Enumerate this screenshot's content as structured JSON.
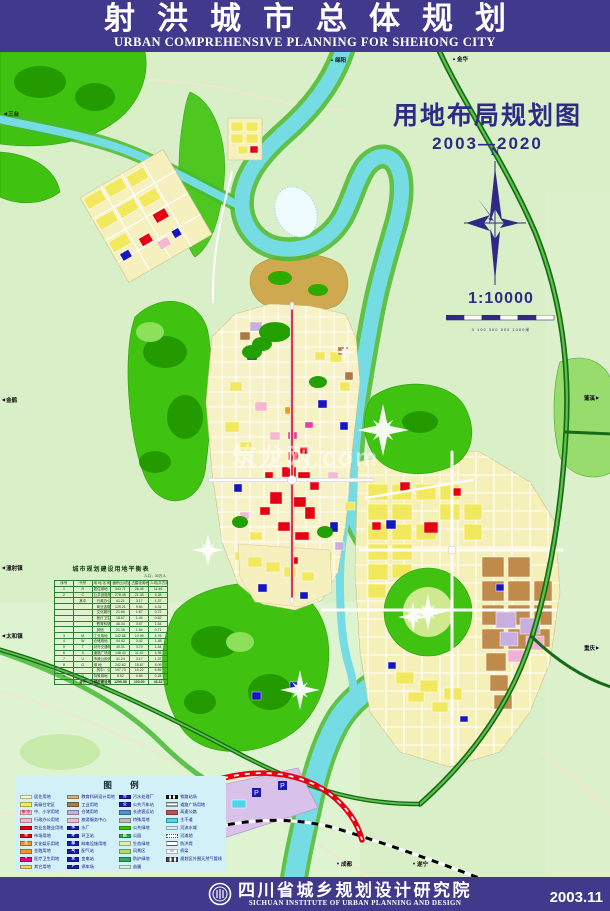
{
  "header": {
    "title_cn": "射洪城市总体规划",
    "title_en": "URBAN COMPREHENSIVE PLANNING FOR SHEHONG CITY"
  },
  "map": {
    "title": "用地布局规划图",
    "period": "2003—2020",
    "compass_label": "N",
    "scale_text": "1:10000",
    "scale_ticks": "0  100  300  500  1000米",
    "watermark": "筑龙网.com",
    "edge_labels": [
      {
        "text": "三台",
        "x": 4,
        "y": 58,
        "dir": "left"
      },
      {
        "text": "绵阳",
        "x": 330,
        "y": 4,
        "dir": "up"
      },
      {
        "text": "金华",
        "x": 452,
        "y": 3,
        "dir": "up"
      },
      {
        "text": "金鹤",
        "x": 2,
        "y": 344,
        "dir": "left"
      },
      {
        "text": "潼射镇",
        "x": 2,
        "y": 512,
        "dir": "left"
      },
      {
        "text": "太和镇",
        "x": 2,
        "y": 580,
        "dir": "left"
      },
      {
        "text": "蓬溪",
        "x": 584,
        "y": 342,
        "dir": "right"
      },
      {
        "text": "重庆",
        "x": 584,
        "y": 592,
        "dir": "right"
      },
      {
        "text": "成都",
        "x": 336,
        "y": 808,
        "dir": "down"
      },
      {
        "text": "遂宁",
        "x": 412,
        "y": 808,
        "dir": "down"
      }
    ]
  },
  "table": {
    "title": "城市规划建设用地平衡表",
    "note": "人口：30万人",
    "headers": [
      "序号",
      "代号",
      "用 地 名 称",
      "面积(公顷)",
      "占建设用地(%)",
      "人均(平方米/人)"
    ],
    "rows": [
      {
        "no": "1",
        "code": "R",
        "name": "居住用地",
        "area": "343.71",
        "pct": "26.45",
        "per": "11.46"
      },
      {
        "no": "2",
        "code": "C",
        "name": "公共设施用地",
        "area": "278.45",
        "pct": "21.43",
        "per": "9.28"
      },
      {
        "no": "",
        "code": "其中",
        "name": "行政办公用地",
        "area": "41.21",
        "pct": "3.17",
        "per": "1.37",
        "sub": true
      },
      {
        "no": "",
        "code": "",
        "name": "商业金融业用地",
        "area": "129.21",
        "pct": "9.94",
        "per": "4.31",
        "sub": true
      },
      {
        "no": "",
        "code": "",
        "name": "文化娱乐用地",
        "area": "21.66",
        "pct": "1.67",
        "per": "0.72",
        "sub": true
      },
      {
        "no": "",
        "code": "",
        "name": "医疗卫生用地",
        "area": "18.67",
        "pct": "1.44",
        "per": "0.62",
        "sub": true
      },
      {
        "no": "",
        "code": "",
        "name": "教育科研设计用地",
        "area": "46.34",
        "pct": "3.57",
        "per": "1.54",
        "sub": true
      },
      {
        "no": "",
        "code": "",
        "name": "其他",
        "area": "21.36",
        "pct": "1.64",
        "per": "0.71",
        "sub": true
      },
      {
        "no": "3",
        "code": "M",
        "name": "工业用地",
        "area": "142.88",
        "pct": "10.99",
        "per": "4.76"
      },
      {
        "no": "4",
        "code": "W",
        "name": "仓储用地",
        "area": "44.42",
        "pct": "3.42",
        "per": "1.48"
      },
      {
        "no": "5",
        "code": "T",
        "name": "对外交通用地",
        "area": "49.31",
        "pct": "3.79",
        "per": "1.64"
      },
      {
        "no": "6",
        "code": "S",
        "name": "道路广场用地",
        "area": "148.43",
        "pct": "11.42",
        "per": "4.95"
      },
      {
        "no": "7",
        "code": "U",
        "name": "市政公用设施用地",
        "area": "41.24",
        "pct": "3.17",
        "per": "1.37"
      },
      {
        "no": "8",
        "code": "G",
        "name": "绿  地",
        "area": "242.62",
        "pct": "18.67",
        "per": "8.09"
      },
      {
        "no": "",
        "code": "",
        "name": "其中：公共绿地",
        "area": "197.73",
        "pct": "15.22",
        "per": "6.59",
        "sub": true
      },
      {
        "no": "9",
        "code": "D",
        "name": "特殊用地",
        "area": "8.52",
        "pct": "0.66",
        "per": "0.28"
      },
      {
        "no": "",
        "code": "合计",
        "name": "城市建设用地",
        "area": "1299.58",
        "pct": "100.00",
        "per": "43.32",
        "total": true
      }
    ]
  },
  "legend": {
    "title": "图 例",
    "columns": [
      {
        "items": [
          {
            "label": "居住用地",
            "swatch": {
              "bg": "#fdf8cd"
            }
          },
          {
            "label": "高级住宅区",
            "swatch": {
              "bg": "#f2ea5e"
            }
          },
          {
            "label": "中、小学用地",
            "swatch": {
              "bg": "#f9ccd9",
              "mark": "中·小",
              "mark_color": "#e60012"
            }
          },
          {
            "label": "行政办公用地",
            "swatch": {
              "bg": "#f5b8ca"
            }
          },
          {
            "label": "商业金融业用地",
            "swatch": {
              "bg": "#e60012"
            }
          },
          {
            "label": "市场用地",
            "swatch": {
              "bg": "#e60012",
              "mark": "市",
              "mark_color": "#ffffff"
            }
          },
          {
            "label": "文化娱乐用地",
            "swatch": {
              "bg": "#f7941d",
              "mark": "文",
              "mark_color": "#ffffff"
            }
          },
          {
            "label": "金融用地",
            "swatch": {
              "bg": "#f7941d"
            }
          },
          {
            "label": "医疗卫生用地",
            "swatch": {
              "bg": "#e6007e",
              "mark": "+",
              "mark_color": "#ffffff"
            }
          },
          {
            "label": "其它用地",
            "swatch": {
              "bg": "#f0d060"
            }
          }
        ]
      },
      {
        "items": [
          {
            "label": "教育科研设计用地",
            "swatch": {
              "bg": "#cdb077"
            }
          },
          {
            "label": "工业用地",
            "swatch": {
              "bg": "#a77d4e"
            }
          },
          {
            "label": "仓储用地",
            "swatch": {
              "bg": "#c9aee0"
            }
          },
          {
            "label": "旅游服务中心",
            "swatch": {
              "bg": "#f5b8ca"
            }
          },
          {
            "label": "水厂",
            "swatch": {
              "bg": "#1a1ab0",
              "mark": "水",
              "mark_color": "#ffffff"
            }
          },
          {
            "label": "环卫站",
            "swatch": {
              "bg": "#1a1ab0",
              "mark": "环",
              "mark_color": "#ffffff"
            }
          },
          {
            "label": "邮电设施用地",
            "swatch": {
              "bg": "#1a1ab0",
              "mark": "邮",
              "mark_color": "#ffffff"
            }
          },
          {
            "label": "配气站",
            "swatch": {
              "bg": "#1a1ab0",
              "mark": "气",
              "mark_color": "#ffffff"
            }
          },
          {
            "label": "变电站",
            "swatch": {
              "bg": "#1a1ab0",
              "mark": "变",
              "mark_color": "#ffffff"
            }
          },
          {
            "label": "停车场",
            "swatch": {
              "bg": "#1a1ab0",
              "mark": "P",
              "mark_color": "#ffffff"
            }
          }
        ]
      },
      {
        "items": [
          {
            "label": "污水处理厂",
            "swatch": {
              "bg": "#1a1ab0",
              "mark": "污",
              "mark_color": "#ffffff"
            }
          },
          {
            "label": "公共汽车站",
            "swatch": {
              "bg": "#1a1ab0",
              "mark": "公",
              "mark_color": "#ffffff"
            }
          },
          {
            "label": "长途客运站",
            "swatch": {
              "bg": "#4f8fd8"
            }
          },
          {
            "label": "特殊用地",
            "swatch": {
              "bg": "#b8bcc0"
            }
          },
          {
            "label": "公共绿地",
            "swatch": {
              "bg": "#33cc00"
            }
          },
          {
            "label": "公园",
            "swatch": {
              "bg": "#22b14c",
              "mark": "园",
              "mark_color": "#ffffff"
            }
          },
          {
            "label": "生态绿地",
            "swatch": {
              "bg": "#d9f2b4"
            }
          },
          {
            "label": "风景区",
            "swatch": {
              "bg": "#a8e063"
            }
          },
          {
            "label": "防护绿地",
            "swatch": {
              "bg": "#2fa860"
            }
          },
          {
            "label": "苗圃",
            "swatch": {
              "bg": "#d6f5d6"
            }
          }
        ]
      },
      {
        "items": [
          {
            "label": "铁路站场",
            "swatch": {
              "type": "rail"
            }
          },
          {
            "label": "道路广场用地",
            "swatch": {
              "type": "stripes"
            }
          },
          {
            "label": "高速公路",
            "swatch": {
              "bg": "#c05050"
            }
          },
          {
            "label": "主干道",
            "swatch": {
              "bg": "#49d6e8"
            }
          },
          {
            "label": "河流水域",
            "swatch": {
              "bg": "#cfeef8"
            }
          },
          {
            "label": "河滩地",
            "swatch": {
              "type": "dots"
            }
          },
          {
            "label": "防洪堤",
            "swatch": {
              "type": "dlines"
            }
          },
          {
            "label": "桥梁",
            "swatch": {
              "bg": "#ffffff",
              "mark": "▭",
              "mark_color": "#e60012"
            }
          },
          {
            "label": "规划区外围天然气管线",
            "swatch": {
              "type": "gasline"
            }
          }
        ]
      }
    ]
  },
  "footer": {
    "org_cn": "四川省城乡规划设计研究院",
    "org_en": "SICHUAN INSTITUTE OF URBAN PLANNING AND DESIGN",
    "date": "2003.11"
  }
}
